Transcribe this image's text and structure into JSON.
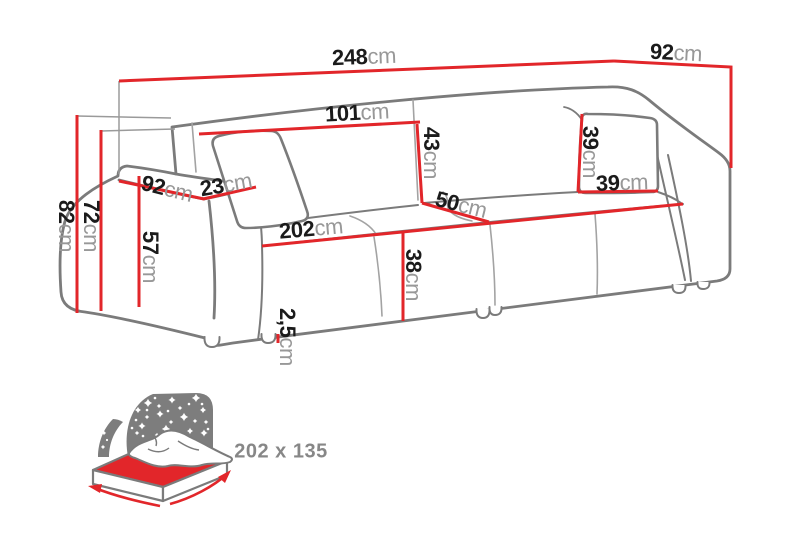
{
  "colors": {
    "dimension_red": "#e2262a",
    "outline_gray": "#7b7b7b",
    "seam_gray": "#a3a3a3",
    "label_number": "#1b1b1b",
    "label_unit": "#989898",
    "sleeping_text": "#878787",
    "headboard_gray": "#7d7d7d"
  },
  "dimensions": {
    "overall_width": {
      "value": "248",
      "unit": "cm"
    },
    "overall_depth": {
      "value": "92",
      "unit": "cm"
    },
    "backrest_width": {
      "value": "101",
      "unit": "cm"
    },
    "backrest_height": {
      "value": "43",
      "unit": "cm"
    },
    "seat_depth": {
      "value": "50",
      "unit": "cm"
    },
    "seat_width": {
      "value": "202",
      "unit": "cm"
    },
    "seat_height": {
      "value": "38",
      "unit": "cm"
    },
    "armrest_front_height": {
      "value": "57",
      "unit": "cm"
    },
    "armrest_depth": {
      "value": "92",
      "unit": "cm"
    },
    "armrest_width": {
      "value": "23",
      "unit": "cm"
    },
    "total_height": {
      "value": "82",
      "unit": "cm"
    },
    "back_height": {
      "value": "72",
      "unit": "cm"
    },
    "leg_height": {
      "value": "2,5",
      "unit": "cm"
    },
    "pillow_height": {
      "value": "39",
      "unit": "cm"
    },
    "pillow_width": {
      "value": "39",
      "unit": "cm"
    }
  },
  "sleeping_area": {
    "size_label": "202 x 135",
    "icon": "bed-night-sky-icon"
  }
}
